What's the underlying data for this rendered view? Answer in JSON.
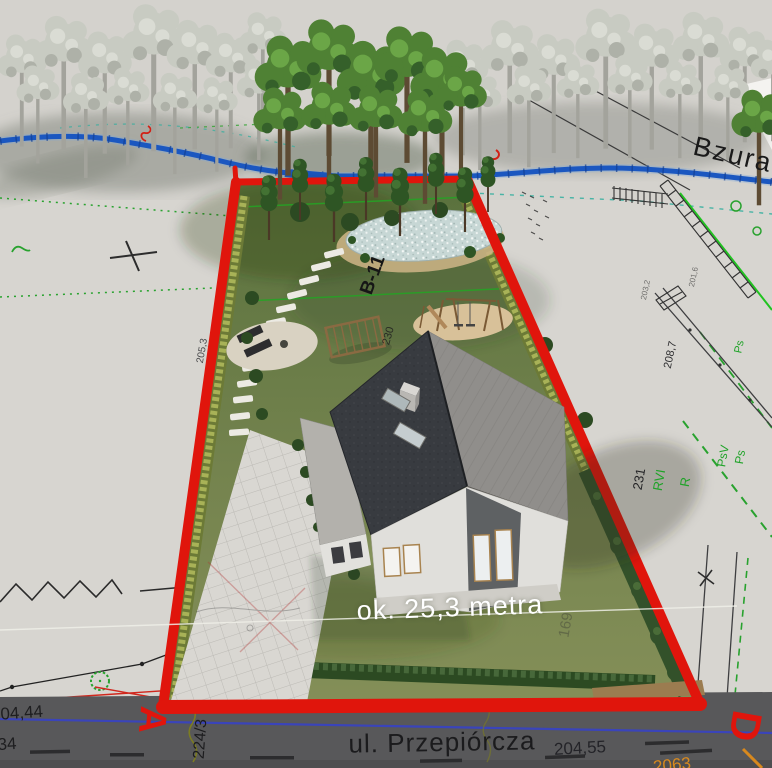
{
  "title": "3D site plan visualization over cadastral map",
  "map": {
    "river_label": "Bzura",
    "street_label": "ul. Przepiórcza"
  },
  "plot": {
    "dimension_label": "ok. 25,3 metra",
    "path_point_label": "B-11",
    "corner_marker_left": "A",
    "corner_marker_right": "D"
  },
  "survey_annotations": {
    "elevation_top_left": "204,44",
    "elevation_bottom_left": "34",
    "road_parcel_number": "224/3",
    "elevation_bottom_right": "204,55",
    "road_number_orange": "2063",
    "elevation_left_boundary": "205,3",
    "elevation_right": "208,7",
    "elevation_top_right_1": "203,2",
    "elevation_top_right_2": "201,6",
    "parcel_number_right": "231",
    "parcel_number_inner": "230",
    "parcel_number_faint": "169",
    "landuse_rvi": "RVI",
    "landuse_r": "R",
    "landuse_psv": "PsV",
    "landuse_ps_upper": "Ps",
    "landuse_ps_lower": "Ps"
  },
  "colors": {
    "plot_boundary_red": "#e0150c",
    "river_blue": "#1b57c0",
    "cadastral_green": "#28a22e",
    "road_asphalt": "#58585a",
    "roof_dark": "#383b40",
    "roof_light": "#908e8b",
    "lawn_green": "#6d7f48",
    "dimension_text": "#ffffff"
  }
}
